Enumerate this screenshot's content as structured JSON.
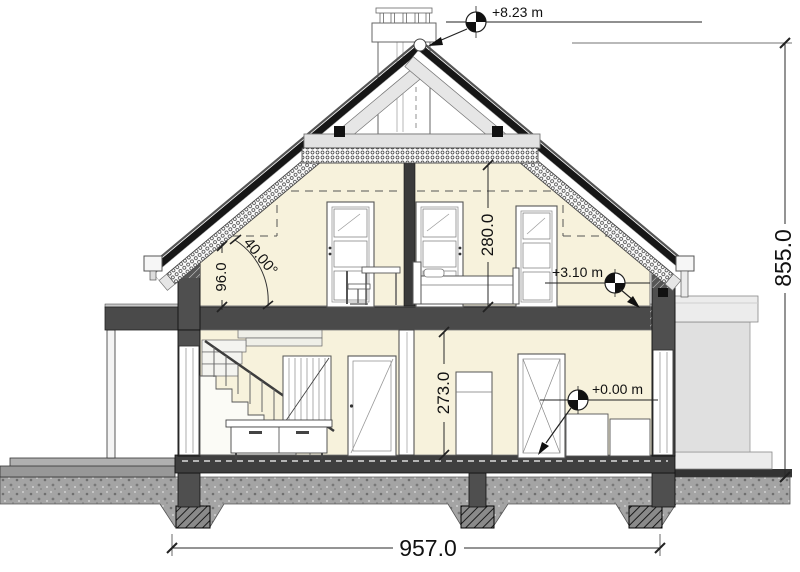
{
  "drawing": {
    "type": "architectural-cross-section",
    "levels": {
      "ridge": "+8.23 m",
      "attic": "+3.10 m",
      "ground": "+0.00 m"
    },
    "dims": {
      "total_width": "957.0",
      "total_height": "855.0",
      "attic_room_height": "280.0",
      "ground_room_height": "273.0",
      "knee_wall_height": "96.0",
      "roof_angle": "40.00°"
    },
    "colors": {
      "interior_fill": "#f7f2dc",
      "structure_dark": "#4f4f4f",
      "roof_dark": "#1a1a1a",
      "rafter_light": "#e6e6e6",
      "ground_gray": "#a4a4a4",
      "annex_gray": "#e0e0e0"
    }
  }
}
